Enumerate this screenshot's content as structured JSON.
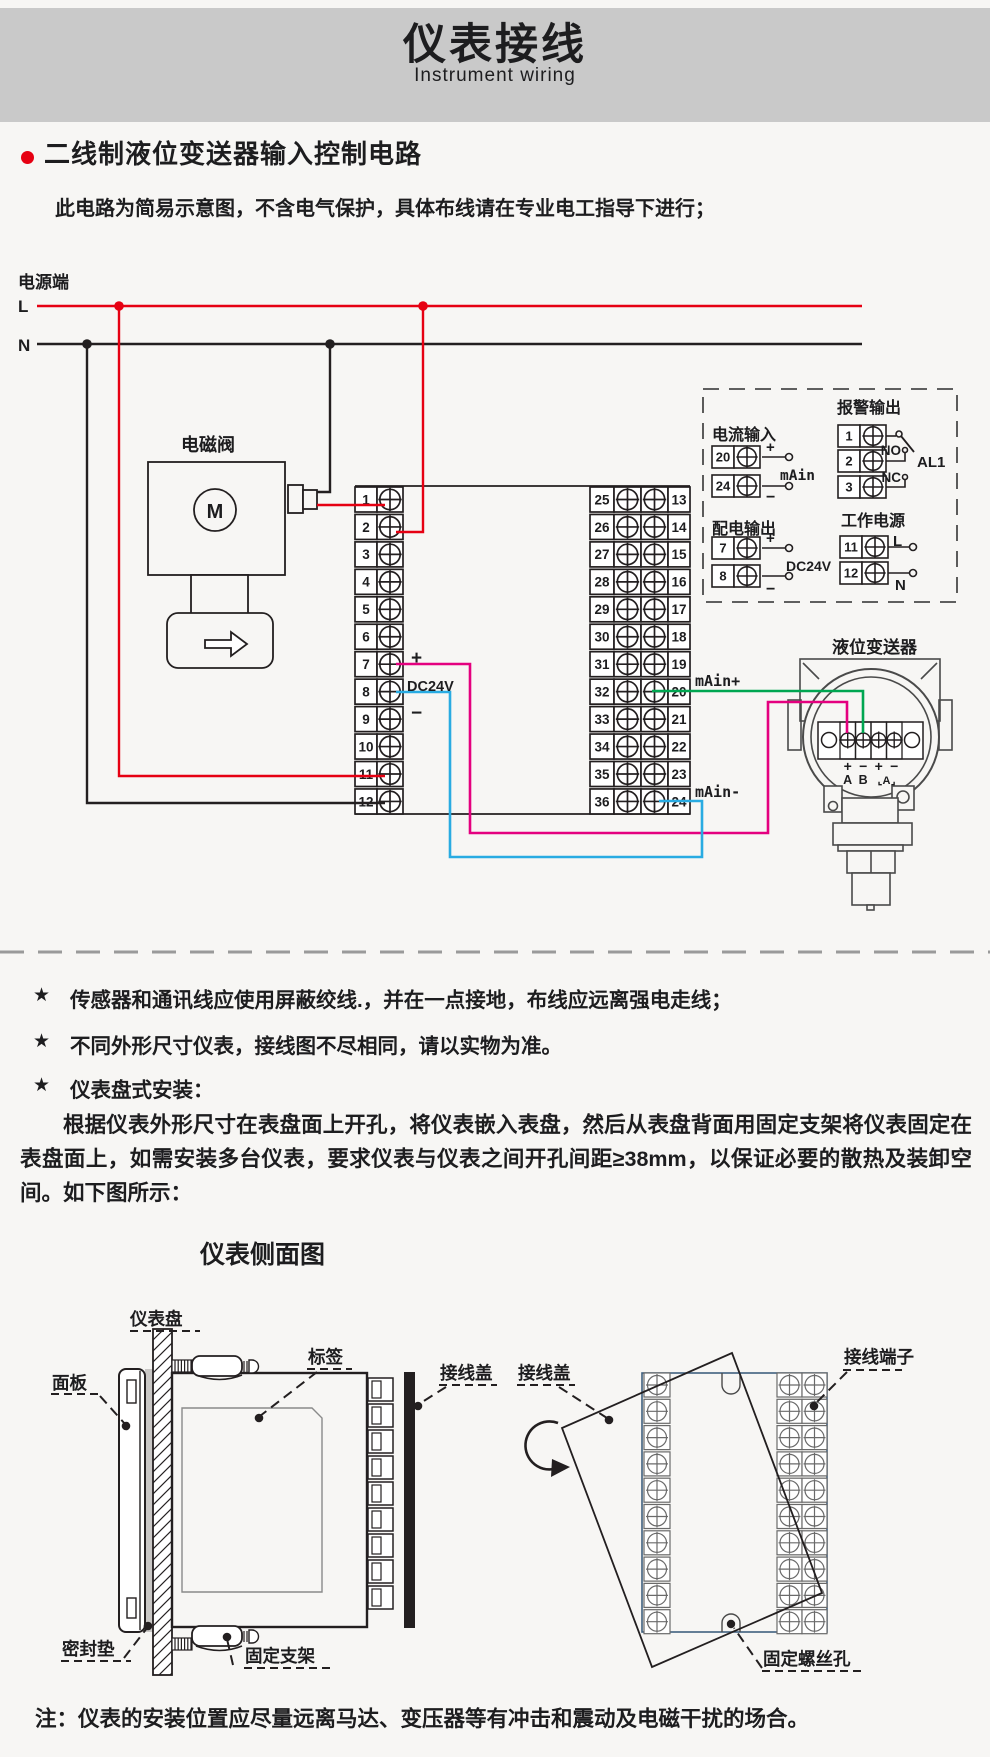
{
  "header": {
    "title": "仪表接线",
    "subtitle": "Instrument wiring",
    "band_color": "#c9c9c9"
  },
  "intro": {
    "bullet_title": "二线制液位变送器输入控制电路",
    "note": "此电路为简易示意图，不含电气保护，具体布线请在专业电工指导下进行；"
  },
  "schematic": {
    "power_side_label": "电源端",
    "l_label": "L",
    "n_label": "N",
    "solenoid_valve_label": "电磁阀",
    "motor_letter": "M",
    "left_terminal_numbers": [
      "1",
      "2",
      "3",
      "4",
      "5",
      "6",
      "7",
      "8",
      "9",
      "10",
      "11",
      "12"
    ],
    "right_terminal_numbers_inner": [
      "25",
      "26",
      "27",
      "28",
      "29",
      "30",
      "31",
      "32",
      "33",
      "34",
      "35",
      "36"
    ],
    "right_terminal_numbers_outer": [
      "13",
      "14",
      "15",
      "16",
      "17",
      "18",
      "19",
      "20",
      "21",
      "22",
      "23",
      "24"
    ],
    "t7_plus": "+",
    "dc24v_label": "DC24V",
    "t8_minus": "−",
    "main_plus_label": "mAin+",
    "main_minus_label": "mAin-",
    "io_box": {
      "current_input": {
        "title": "电流输入",
        "terminal_top": "20",
        "terminal_bottom": "24",
        "plus": "+",
        "minus": "−",
        "signal_label": "mAin"
      },
      "alarm_output": {
        "title": "报警输出",
        "terminals": [
          "1",
          "2",
          "3"
        ],
        "no_label": "NO",
        "nc_label": "NC",
        "relay_label": "AL1"
      },
      "distribution_output": {
        "title": "配电输出",
        "terminal_top": "7",
        "terminal_bottom": "8",
        "plus": "+",
        "minus": "−",
        "voltage_label": "DC24V"
      },
      "working_power": {
        "title": "工作电源",
        "terminal_top": "11",
        "terminal_bottom": "12",
        "l_label": "L",
        "n_label": "N"
      }
    },
    "transmitter": {
      "title": "液位变送器",
      "polarity_labels": [
        "+",
        "−",
        "+",
        "−"
      ],
      "port_labels": [
        "A",
        "B"
      ],
      "comm_label": "⌞A⌟"
    }
  },
  "notes": {
    "star": "★",
    "items": [
      "传感器和通讯线应使用屏蔽绞线.，并在一点接地，布线应远离强电走线；",
      "不同外形尺寸仪表，接线图不尽相同，请以实物为准。",
      "仪表盘式安装："
    ]
  },
  "install_paragraph": "根据仪表外形尺寸在表盘面上开孔，将仪表嵌入表盘，然后从表盘背面用固定支架将仪表固定在表盘面上，如需安装多台仪表，要求仪表与仪表之间开孔间距≥38mm，以保证必要的散热及装卸空间。如下图所示：",
  "side_view": {
    "title": "仪表侧面图",
    "panel_label": "仪表盘",
    "front_panel_label": "面板",
    "tag_label": "标签",
    "cover_label": "接线盖",
    "gasket_label": "密封垫",
    "bracket_label": "固定支架"
  },
  "rear_view": {
    "cover_label": "接线盖",
    "terminal_label": "接线端子",
    "screw_hole_label": "固定螺丝孔"
  },
  "footer_note": "注：仪表的安装位置应尽量远离马达、变压器等有冲击和震动及电磁干扰的场合。",
  "colors": {
    "line_red": "#e60012",
    "line_blue": "#29abe2",
    "line_magenta": "#e4007f",
    "line_green": "#00a651",
    "ink": "#231f20",
    "rear_body_stroke": "#40607f"
  }
}
